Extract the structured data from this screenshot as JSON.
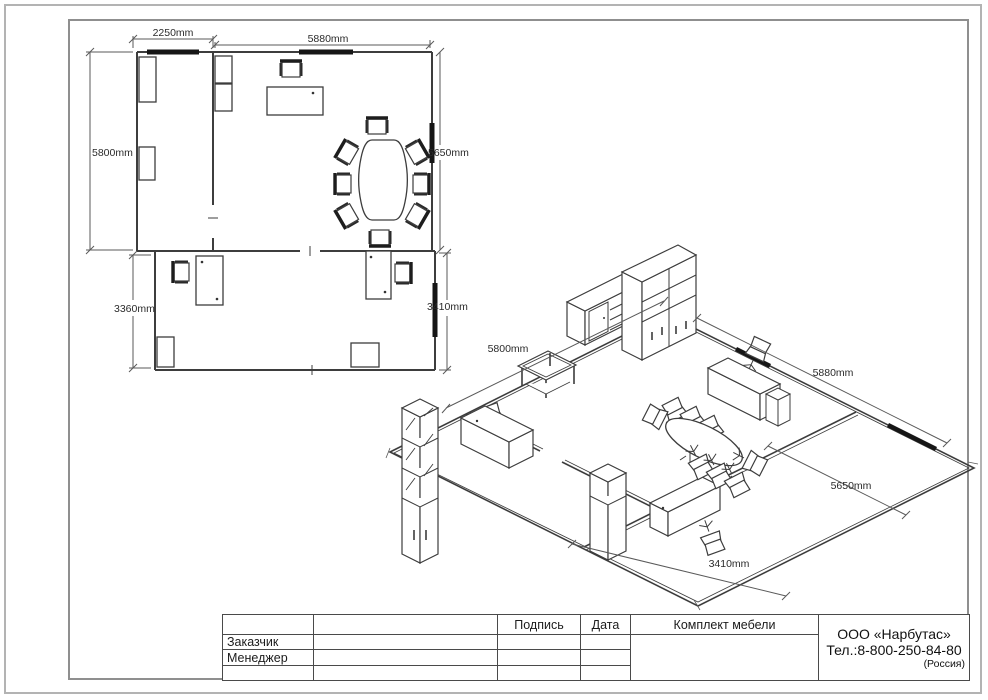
{
  "sheet": {
    "kind": "furniture layout drawing"
  },
  "floor_plan_2d": {
    "dimensions": {
      "room_a_width": "2250mm",
      "room_b_width": "5880mm",
      "room_a_height": "5800mm",
      "room_b_height": "5650mm",
      "room_c_height_left": "3360mm",
      "room_c_height_right": "3410mm"
    }
  },
  "iso_view": {
    "dimensions": {
      "back_left_wall": "5800mm",
      "back_right_wall": "5880mm",
      "right_wall": "5650mm",
      "front_wall": "3410mm"
    }
  },
  "title_block": {
    "signature_label": "Подпись",
    "date_label": "Дата",
    "project_title": "Комплект мебели",
    "customer_label": "Заказчик",
    "manager_label": "Менеджер",
    "company_name": "ООО «Нарбутас»",
    "company_phone": "Тел.:8-800-250-84-80",
    "company_country": "(Россия)"
  }
}
